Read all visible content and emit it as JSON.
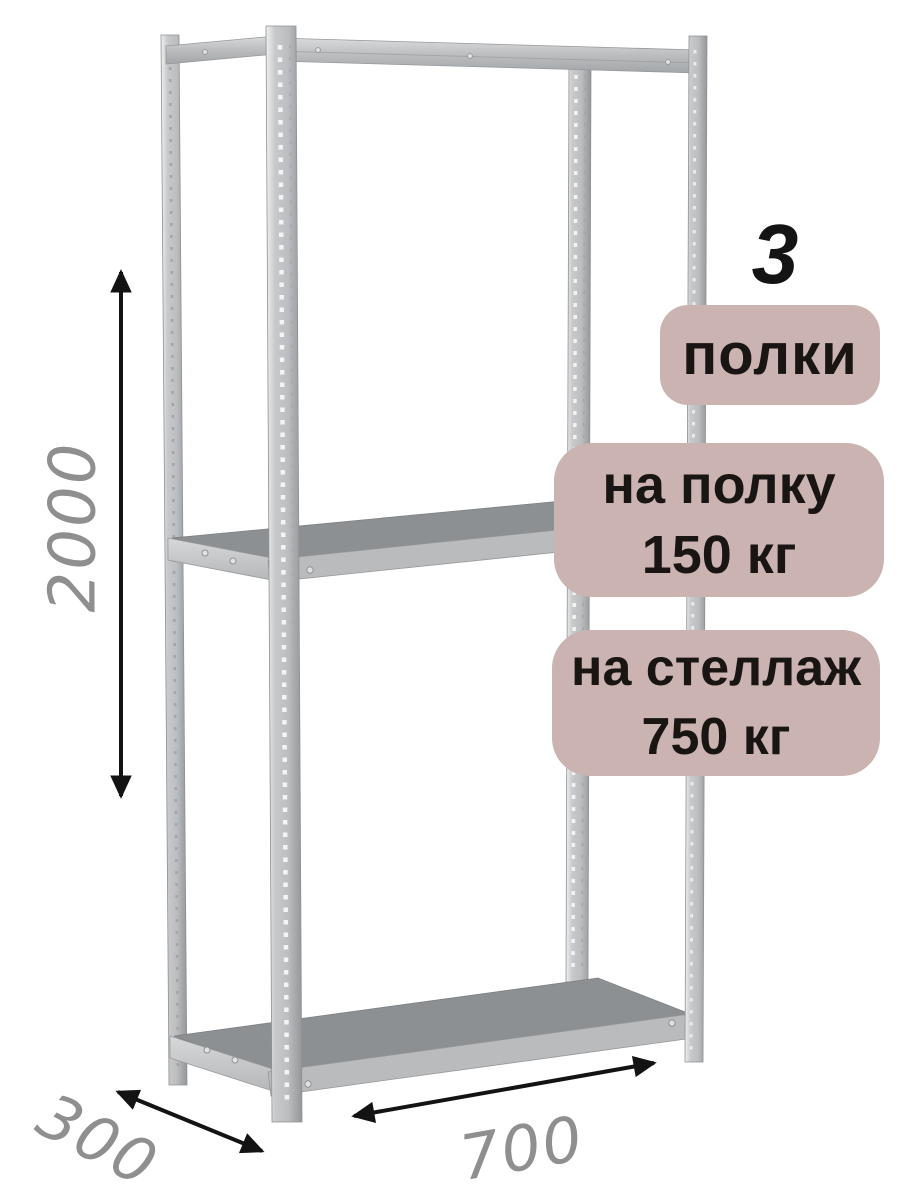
{
  "badges": {
    "shelf_count": {
      "value": "3",
      "label": "полки"
    },
    "per_shelf": {
      "line1": "на полку",
      "line2": "150 кг"
    },
    "per_rack": {
      "line1": "на стеллаж",
      "line2": "750 кг"
    }
  },
  "dimensions": {
    "height": "2000",
    "depth": "300",
    "width": "700"
  },
  "colors": {
    "background": "#ffffff",
    "badge_bg": "#cbb3b1",
    "badge_text": "#181512",
    "dimension_text": "#8f8f8f",
    "arrow": "#131313",
    "metal_light": "#eceded",
    "metal_mid": "#c7c9cb",
    "metal_dark": "#989b9e",
    "shelf_top": "#8d9092",
    "shelf_front": "#b9bbbd"
  }
}
